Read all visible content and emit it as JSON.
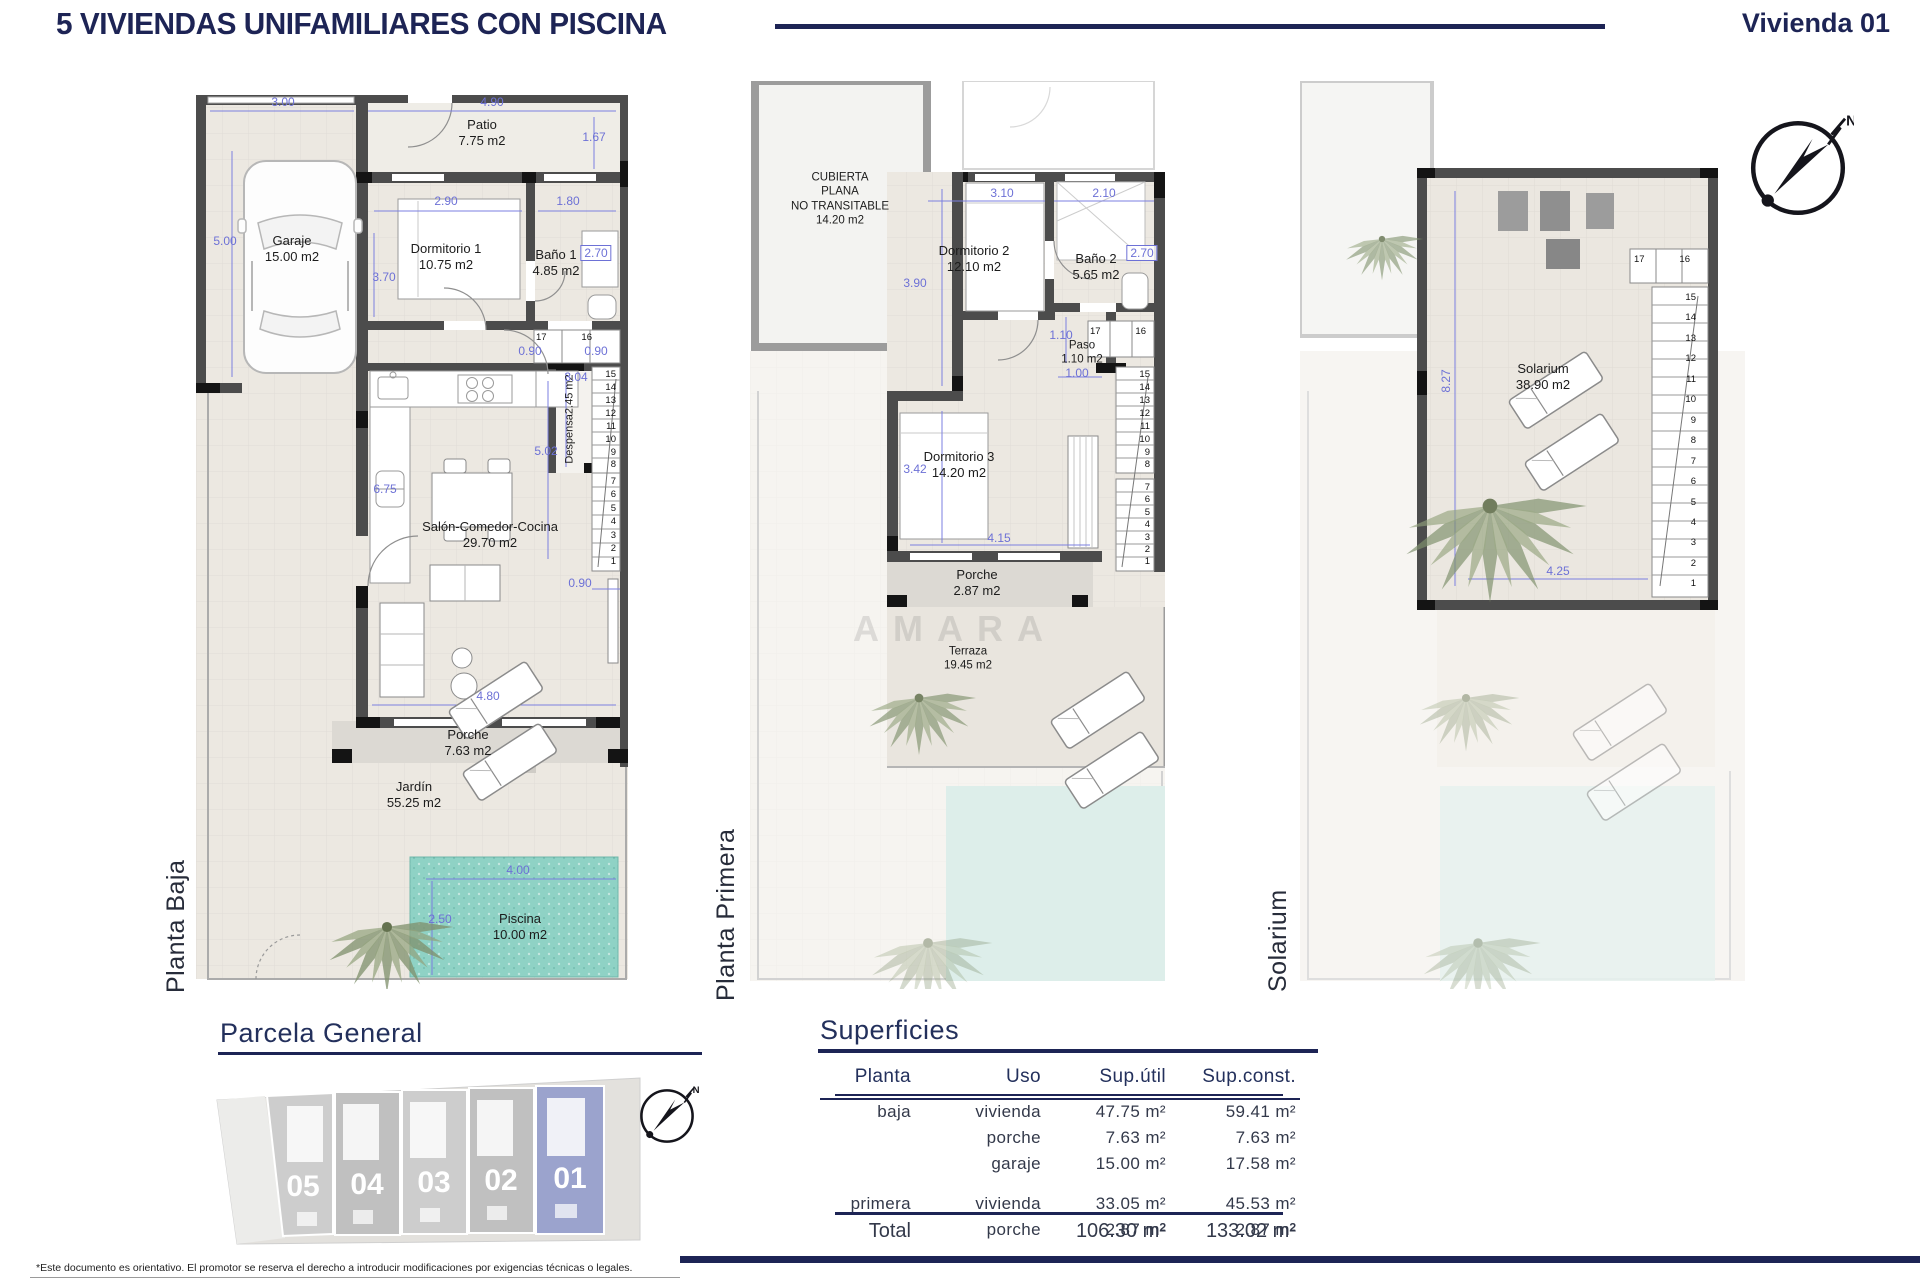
{
  "header": {
    "title": "5 VIVIENDAS UNIFAMILIARES CON PISCINA",
    "unit": "Vivienda 01"
  },
  "colors": {
    "navy": "#1d2455",
    "dim_blue": "#6d71d6",
    "wall_dark": "#4c4c4c",
    "pool_teal": "#8fd2c5",
    "plot_highlight": "#9ba3cd"
  },
  "compass": {
    "north": "N"
  },
  "plans": {
    "baja": {
      "label": "Planta Baja",
      "rooms": {
        "patio": {
          "name": "Patio",
          "area": "7.75 m2"
        },
        "garaje": {
          "name": "Garaje",
          "area": "15.00 m2"
        },
        "dormitorio1": {
          "name": "Dormitorio 1",
          "area": "10.75 m2"
        },
        "bano1": {
          "name": "Baño 1",
          "area": "4.85 m2"
        },
        "despensa": {
          "name": "Despensa",
          "area": "2.45 m2"
        },
        "salon": {
          "name": "Salón-Comedor-Cocina",
          "area": "29.70 m2"
        },
        "porche": {
          "name": "Porche",
          "area": "7.63 m2"
        },
        "jardin": {
          "name": "Jardín",
          "area": "55.25 m2"
        },
        "piscina": {
          "name": "Piscina",
          "area": "10.00 m2"
        }
      },
      "dims": {
        "garage_width": "3.00",
        "patio_width": "4.90",
        "garage_depth": "5.00",
        "patio_depth": "1.67",
        "dorm1_width": "2.90",
        "bano1_width": "1.80",
        "bano1_depth": "2.70",
        "dorm1_depth": "3.70",
        "hall_left": "0.90",
        "hall_right": "0.90",
        "despensa_depth": "3.04",
        "salon_depth": "5.02",
        "salon_left": "6.75",
        "salon_width": "4.80",
        "stair_width": "0.90",
        "pool_width": "4.00",
        "pool_depth": "2.50"
      },
      "stairs_upper": [
        "17",
        "16"
      ],
      "stairs_mid": [
        "15",
        "14",
        "13",
        "12",
        "11",
        "10",
        "9",
        "8"
      ],
      "stairs_low": [
        "7",
        "6",
        "5",
        "4",
        "3",
        "2",
        "1"
      ]
    },
    "primera": {
      "label": "Planta Primera",
      "rooms": {
        "cubierta": {
          "line1": "CUBIERTA",
          "line2": "PLANA",
          "line3": "NO TRANSITABLE",
          "area": "14.20 m2"
        },
        "dormitorio2": {
          "name": "Dormitorio 2",
          "area": "12.10 m2"
        },
        "bano2": {
          "name": "Baño 2",
          "area": "5.65 m2"
        },
        "paso": {
          "name": "Paso",
          "area": "1.10 m2"
        },
        "dormitorio3": {
          "name": "Dormitorio 3",
          "area": "14.20 m2"
        },
        "porche": {
          "name": "Porche",
          "area": "2.87 m2"
        },
        "terraza": {
          "name": "Terraza",
          "area": "19.45 m2"
        }
      },
      "dims": {
        "dorm2_width": "3.10",
        "bano2_width": "2.10",
        "dorm2_depth": "3.90",
        "bano2_depth": "2.70",
        "paso_depth": "1.10",
        "paso_width": "1.00",
        "dorm3_depth": "3.42",
        "dorm3_width": "4.15"
      },
      "stairs_upper": [
        "17",
        "16"
      ],
      "stairs_mid": [
        "15",
        "14",
        "13",
        "12",
        "11",
        "10",
        "9",
        "8"
      ],
      "stairs_low": [
        "7",
        "6",
        "5",
        "4",
        "3",
        "2",
        "1"
      ],
      "watermark": "AMARA"
    },
    "solarium": {
      "label": "Solarium",
      "rooms": {
        "solarium": {
          "name": "Solarium",
          "area": "38.90 m2"
        }
      },
      "dims": {
        "depth": "8.27",
        "width": "4.25"
      },
      "stairs_upper": [
        "17",
        "16"
      ],
      "stairs_all": [
        "15",
        "14",
        "13",
        "12",
        "11",
        "10",
        "9",
        "8",
        "7",
        "6",
        "5",
        "4",
        "3",
        "2",
        "1"
      ]
    }
  },
  "parcela": {
    "title": "Parcela General",
    "plots": [
      "05",
      "04",
      "03",
      "02",
      "01"
    ],
    "highlighted_plot": "01"
  },
  "superficies": {
    "title": "Superficies",
    "headers": [
      "Planta",
      "Uso",
      "Sup.útil",
      "Sup.const."
    ],
    "groups": [
      {
        "planta": "baja",
        "rows": [
          [
            "vivienda",
            "47.75 m²",
            "59.41 m²"
          ],
          [
            "porche",
            "7.63 m²",
            "7.63 m²"
          ],
          [
            "garaje",
            "15.00 m²",
            "17.58 m²"
          ]
        ]
      },
      {
        "planta": "primera",
        "rows": [
          [
            "vivienda",
            "33.05 m²",
            "45.53 m²"
          ],
          [
            "porche",
            "2.87 m²",
            "2.87 m²"
          ]
        ]
      }
    ],
    "total_label": "Total",
    "total_util": "106.30 m²",
    "total_const": "133.02 m²"
  },
  "footer": {
    "disclaimer": "*Este documento es orientativo. El promotor se reserva el derecho a introducir modificaciones por exigencias técnicas o legales."
  }
}
